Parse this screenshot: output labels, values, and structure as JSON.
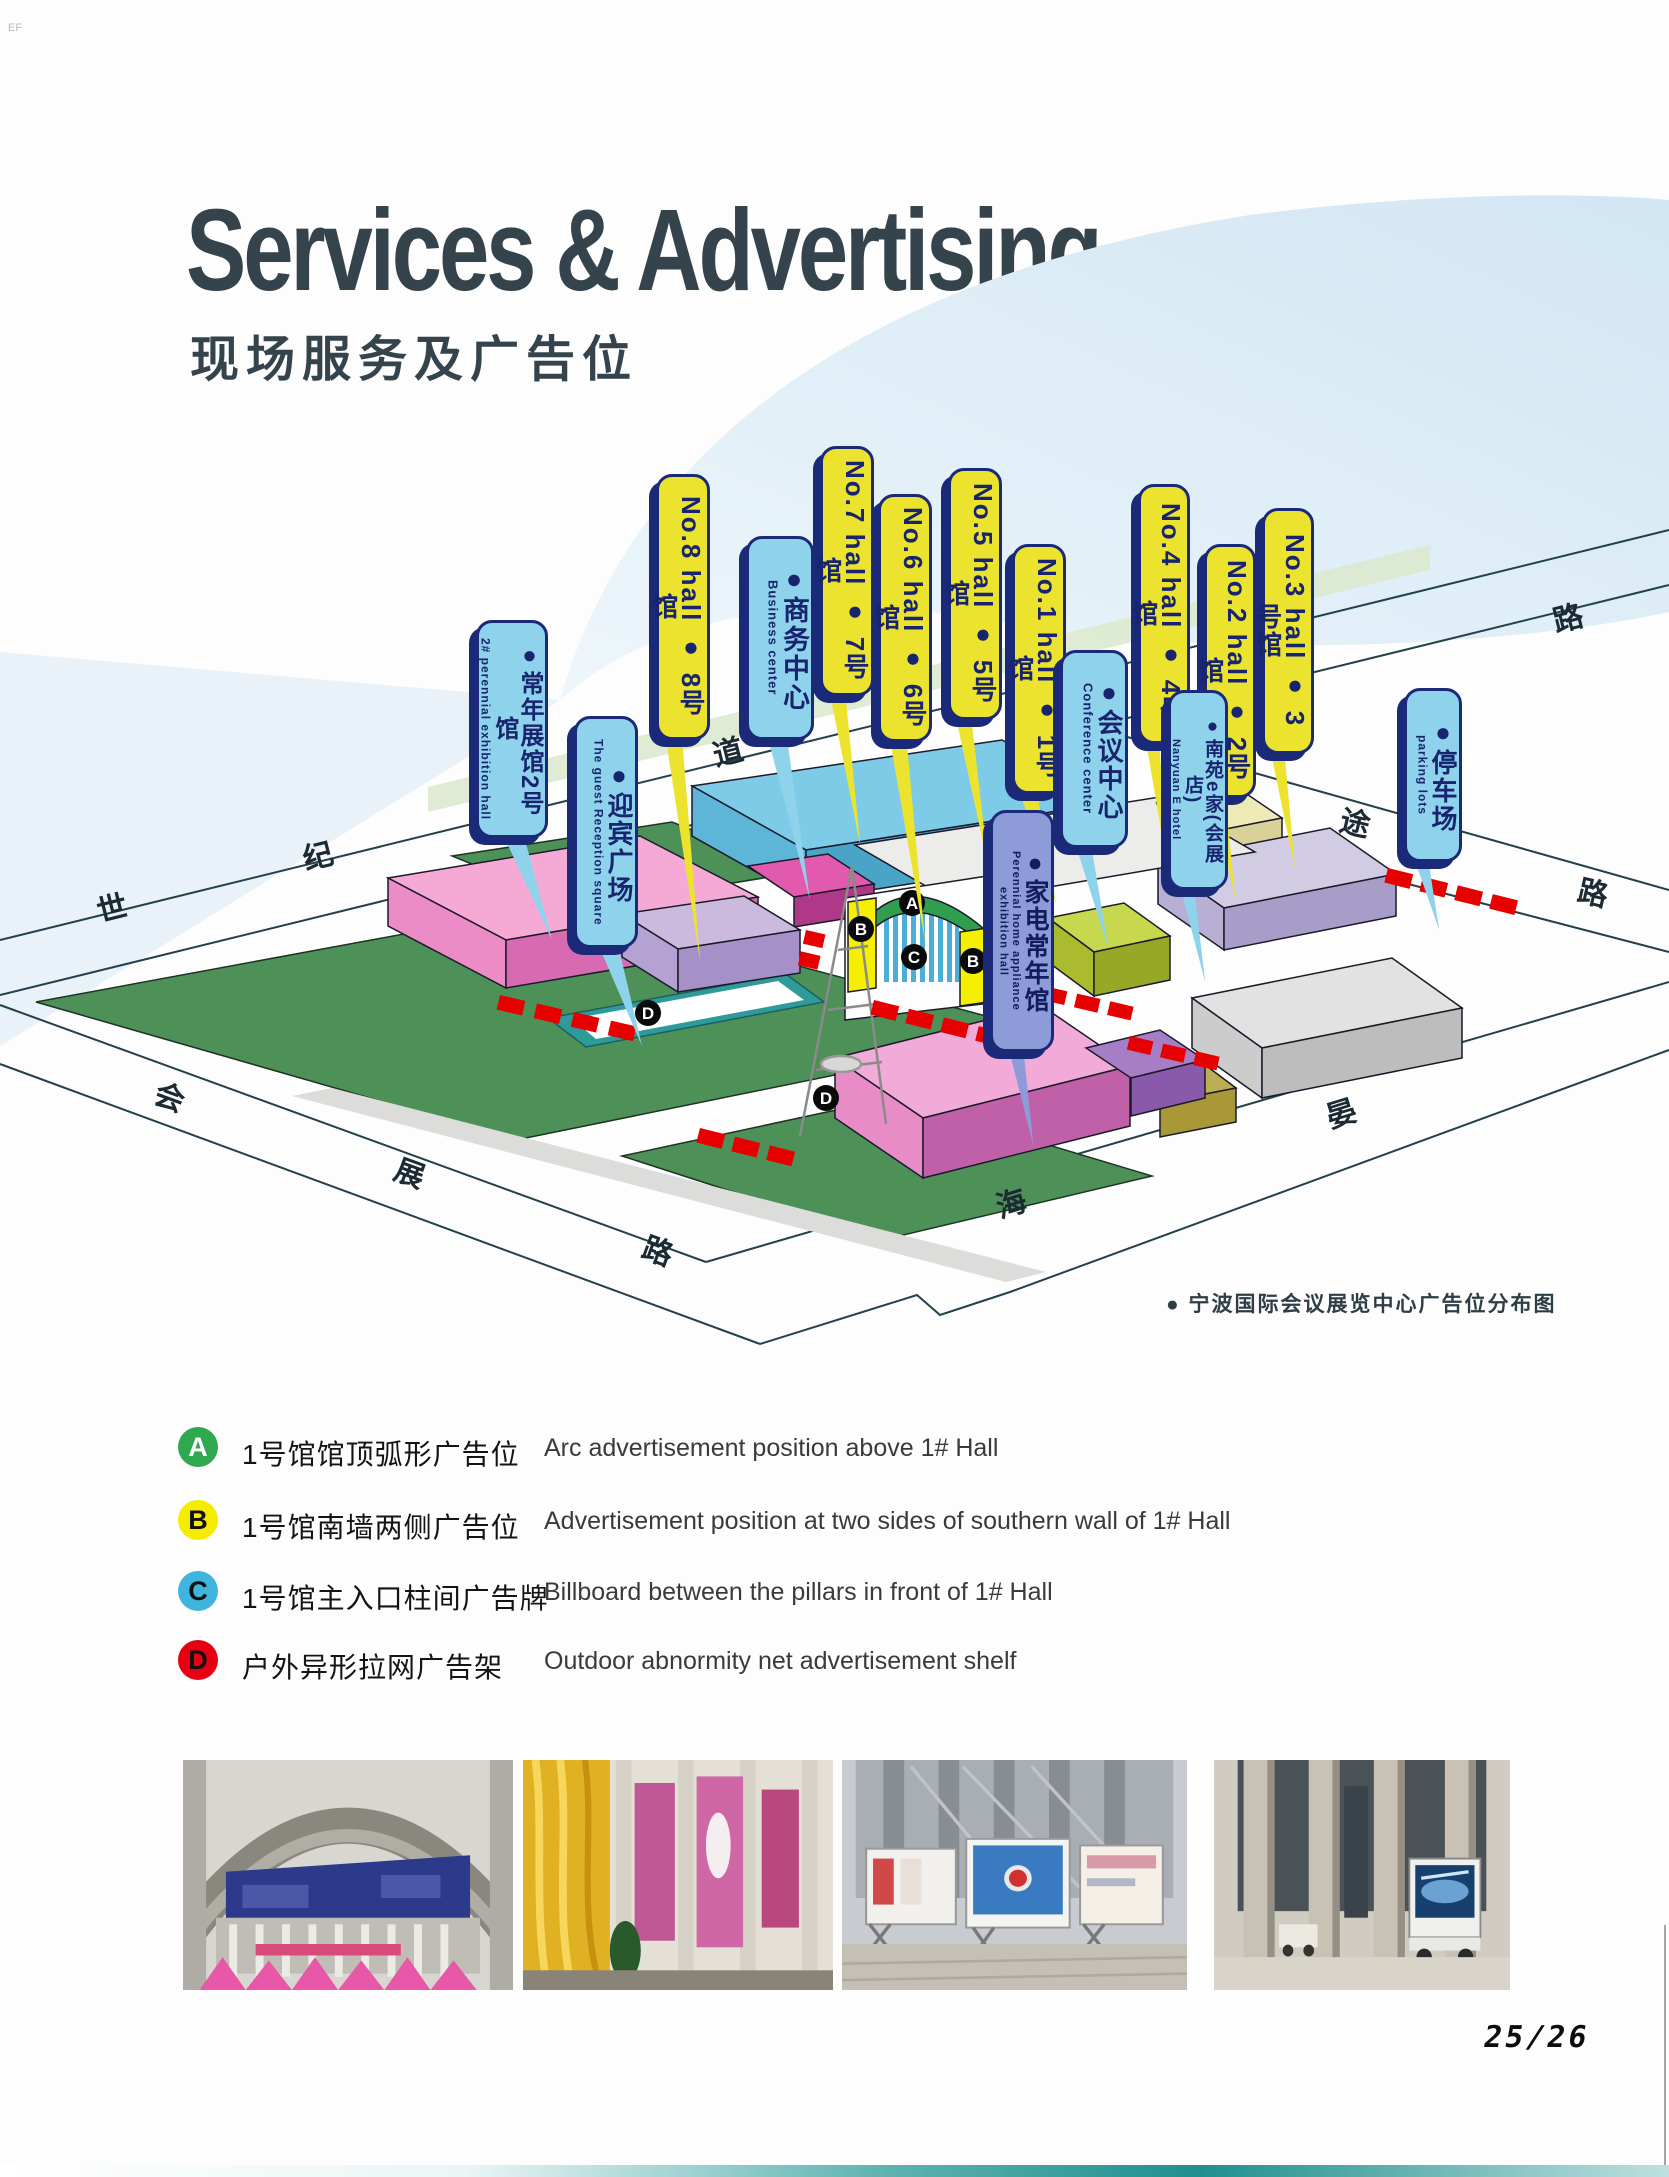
{
  "page": {
    "corner_mark": "EF",
    "title_en": "Services & Advertising",
    "title_cn": "现场服务及广告位",
    "page_number": "25/26"
  },
  "map": {
    "caption": "●  宁波国际会议展览中心广告位分布图",
    "streets": {
      "avenue": [
        "世",
        "纪",
        "大",
        "道"
      ],
      "huizhan": [
        "会",
        "展",
        "路"
      ],
      "haiyan": [
        "海",
        "晏"
      ],
      "tongtu": [
        "通",
        "途",
        "路"
      ],
      "extra_lu": "路"
    },
    "banners": [
      {
        "id": "perennial-2",
        "main": "●常年展馆2号馆",
        "sub": "2# perennial exhibition hall"
      },
      {
        "id": "reception-square",
        "main": "●迎宾广场",
        "sub": "The guest Reception square"
      },
      {
        "id": "hall-8",
        "main": "No.8 hall ● 8号馆"
      },
      {
        "id": "business-center",
        "main": "●商务中心",
        "sub": "Business center"
      },
      {
        "id": "hall-7",
        "main": "No.7 hall ● 7号馆"
      },
      {
        "id": "hall-6",
        "main": "No.6 hall ● 6号馆"
      },
      {
        "id": "hall-5",
        "main": "No.5 hall ● 5号馆"
      },
      {
        "id": "hall-1",
        "main": "No.1 hall ● 1号馆"
      },
      {
        "id": "conference-center",
        "main": "●会议中心",
        "sub": "Conference center"
      },
      {
        "id": "hall-4",
        "main": "No.4 hall ● 4号馆"
      },
      {
        "id": "nanyuan-e-home",
        "main": "●南苑e家(会展店)",
        "sub": "Nanyuan E hotel"
      },
      {
        "id": "hall-2",
        "main": "No.2 hall ● 2号馆"
      },
      {
        "id": "hall-3",
        "main": "No.3 hall ● 3号馆"
      },
      {
        "id": "parking",
        "main": "●停车场",
        "sub": "parking lots"
      },
      {
        "id": "appliance-hall",
        "main": "●家电常年馆",
        "sub": "Perennial home appliance exhibition hall"
      }
    ],
    "markers": [
      {
        "label": "A"
      },
      {
        "label": "B"
      },
      {
        "label": "C"
      },
      {
        "label": "B"
      },
      {
        "label": "D"
      },
      {
        "label": "D"
      }
    ]
  },
  "legend": {
    "items": [
      {
        "letter": "A",
        "color": "#2fa84f",
        "letter_color": "#ffffff",
        "cn": "1号馆馆顶弧形广告位",
        "en": "Arc advertisement position above 1# Hall"
      },
      {
        "letter": "B",
        "color": "#f6ec00",
        "letter_color": "#111111",
        "cn": "1号馆南墙两侧广告位",
        "en": "Advertisement position at two sides of southern wall of 1# Hall"
      },
      {
        "letter": "C",
        "color": "#3fb4dc",
        "letter_color": "#111111",
        "cn": "1号馆主入口柱间广告牌",
        "en": "Billboard between the pillars in front of 1# Hall"
      },
      {
        "letter": "D",
        "color": "#e60012",
        "letter_color": "#111111",
        "cn": "户外异形拉网广告架",
        "en": "Outdoor abnormity net advertisement shelf"
      }
    ]
  },
  "colors": {
    "title": "#35444c",
    "banner_yellow": "#ece32e",
    "banner_blue": "#8ed2ec",
    "banner_periwinkle": "#8d9bd8",
    "banner_outline": "#1b2a78",
    "lawn_green": "#4e9158",
    "red_ad_shelf": "#e60000",
    "bottom_strip_teal": "#1f8f8d"
  }
}
